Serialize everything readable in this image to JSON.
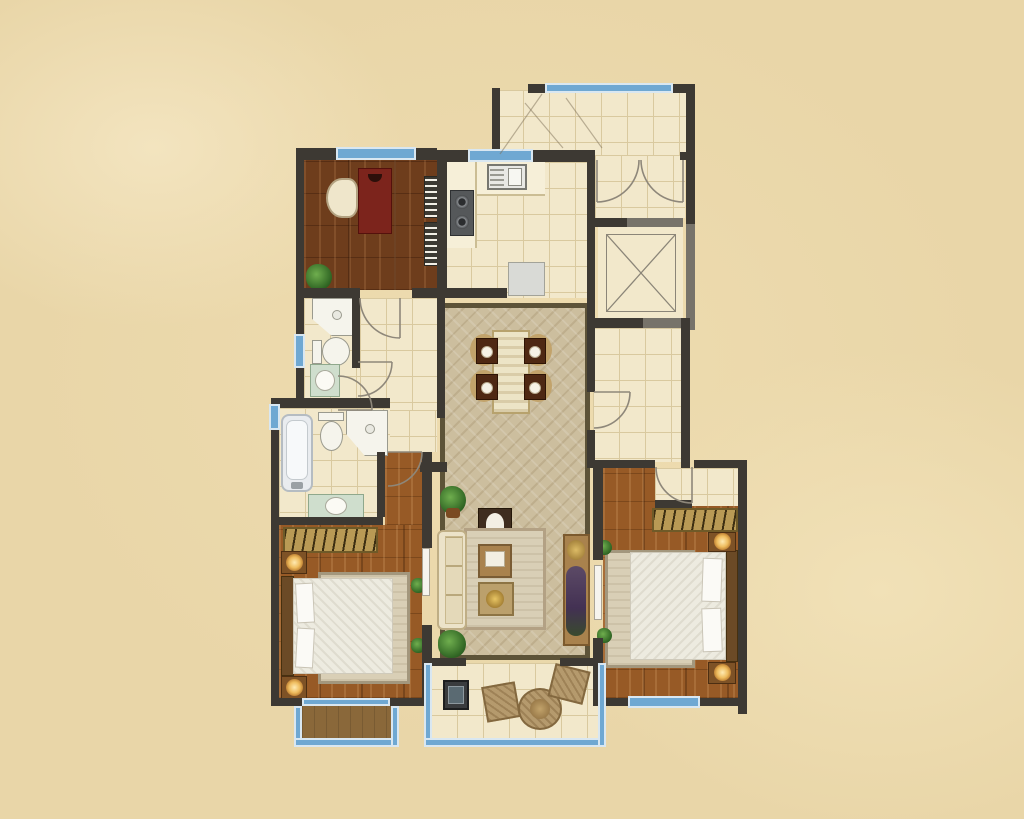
{
  "document": {
    "kind": "apartment-floor-plan-rendering",
    "canvas_px": {
      "width": 1024,
      "height": 819
    },
    "visible_text": [],
    "orientation": "top-down plan view, no dimension labels or room name text rendered"
  },
  "palette": {
    "bg": "#e9d6a8",
    "wall": "#3d3933",
    "wallGray": "#77736a",
    "windowBlue": "#6fa8d2",
    "windowPale": "#d9e7f1",
    "tile": "#f2e8cb",
    "tileLine": "#d9c99f",
    "studyWood": "#6e3d1c",
    "bedroomWood": "#975a26",
    "balconyWood": "#8a683a",
    "rugField": "#ccbe9e",
    "rugBorder": "#5d5338",
    "areaRug": "#d9cfb6",
    "bedding": "#edebe0",
    "headboard": "#6b4a26",
    "sofa": "#ece3c9",
    "furnWood": "#a9824d",
    "deskRed": "#7c241c",
    "diningChair": "#4e2813",
    "fixtureWhite": "#f5f4ec",
    "vanityGreen": "#cfdecd",
    "applianceDark": "#3a3c3e",
    "applianceGray": "#d9dad6",
    "wicker": "#b59a6d",
    "glowLamp": "#eebc5e",
    "plantGreen": "#2f6423"
  },
  "rooms": [
    {
      "id": "entry-hall",
      "floor": "tile",
      "features": [
        "top-window",
        "diagonal-corner-niche"
      ]
    },
    {
      "id": "entry-foyer",
      "floor": "tile",
      "features": [
        "double-entry-doors"
      ]
    },
    {
      "id": "elevator-shaft",
      "floor": "plain",
      "features": [
        "x-cross-marking"
      ]
    },
    {
      "id": "study",
      "floor": "dark-wood",
      "furniture": [
        "desk",
        "chair",
        "shelf",
        "shelf",
        "plant"
      ]
    },
    {
      "id": "kitchen",
      "floor": "tile",
      "furniture": [
        "sink-double",
        "counter",
        "cooktop-2-burner",
        "refrigerator"
      ]
    },
    {
      "id": "corridor",
      "floor": "tile",
      "furniture": [
        "door-arc"
      ]
    },
    {
      "id": "hallway",
      "floor": "tile",
      "furniture": []
    },
    {
      "id": "bathroom-upper",
      "floor": "tile",
      "furniture": [
        "corner-shower",
        "toilet",
        "vanity-basin"
      ],
      "features": [
        "left-window"
      ]
    },
    {
      "id": "bathroom-lower",
      "floor": "tile",
      "furniture": [
        "bathtub",
        "toilet",
        "corner-shower",
        "vanity-basin"
      ],
      "features": [
        "left-window"
      ]
    },
    {
      "id": "dining-area",
      "floor": "patterned-rug",
      "furniture": [
        "dining-table",
        "chair",
        "chair",
        "chair",
        "chair"
      ]
    },
    {
      "id": "living-room",
      "floor": "patterned-rug",
      "furniture": [
        "sofa",
        "area-rug",
        "coffee-table",
        "side-arrangement",
        "tv-cabinet",
        "display-niche",
        "plant",
        "plant"
      ]
    },
    {
      "id": "bedroom-left",
      "floor": "wood",
      "furniture": [
        "wardrobe",
        "double-bed",
        "pillows",
        "nightstand-lamp",
        "nightstand-lamp",
        "area-rug",
        "plant",
        "plant",
        "door-leaf"
      ],
      "features": [
        "balcony-access"
      ]
    },
    {
      "id": "bedroom-right",
      "floor": "wood",
      "furniture": [
        "wardrobe",
        "double-bed",
        "pillows",
        "nightstand-lamp",
        "nightstand-lamp",
        "area-rug",
        "plant",
        "plant",
        "door-leaf"
      ],
      "features": [
        "entry-nook",
        "bottom-window"
      ]
    },
    {
      "id": "balcony-left",
      "floor": "brown-wood",
      "features": [
        "window-rail"
      ]
    },
    {
      "id": "balcony-main",
      "floor": "tile",
      "furniture": [
        "washing-machine",
        "wicker-chair",
        "wicker-round-table",
        "wicker-chair"
      ],
      "features": [
        "window-rail"
      ]
    }
  ],
  "window_segments": 9,
  "door_arcs": 7
}
